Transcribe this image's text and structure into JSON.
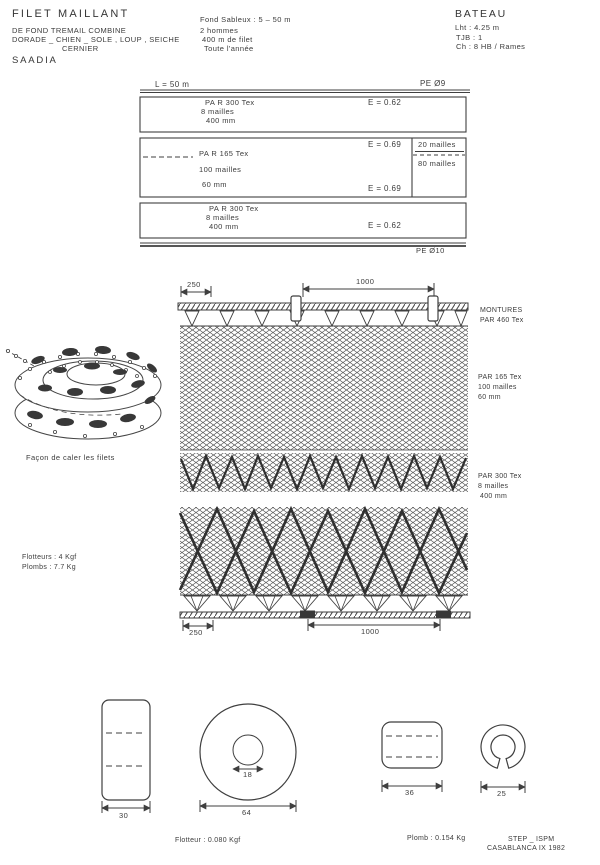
{
  "doc": {
    "title": "FILET MAILLANT",
    "type_line": "DE FOND TREMAIL COMBINE",
    "species_line": "DORADE _ CHIEN _ SOLE , LOUP , SEICHE",
    "species_line2": "CERNIER",
    "port": "SAADIA",
    "conditions": [
      "Fond Sableux : 5 – 50 m",
      "2 hommes",
      "400 m de filet",
      "Toute l'année"
    ],
    "boat_title": "BATEAU",
    "boat_specs": [
      "Lht : 4.25 m",
      "TJB : 1",
      "Ch : 8 HB / Rames"
    ]
  },
  "plan": {
    "length": "L = 50 m",
    "rope_top": "PE Ø9",
    "rope_bottom": "PE Ø10",
    "p1_material": "PA R 300 Tex",
    "p1_meshes": "8 mailles",
    "p1_size": "400 mm",
    "p1_e": "E = 0.62",
    "p2_material": "PA R 165 Tex",
    "p2_meshes": "100 mailles",
    "p2_size": "60 mm",
    "p2_e_top": "E = 0.69",
    "p2_e_bot": "E = 0.69",
    "p2_sub_top": "20 mailles",
    "p2_sub_bot": "80 mailles",
    "p3_material": "PA R 300 Tex",
    "p3_meshes": "8 mailles",
    "p3_size": "400 mm",
    "p3_e": "E = 0.62"
  },
  "detail": {
    "dim_top_left": "250",
    "dim_top_center": "1000",
    "dim_bot_left": "250",
    "dim_bot_center": "1000",
    "montures1": "MONTURES",
    "montures2": "PAR 460 Tex",
    "mid1": "PAR 165 Tex",
    "mid2": "100 mailles",
    "mid3": "60 mm",
    "low1": "PAR 300 Tex",
    "low2": "8 mailles",
    "low3": "400 mm"
  },
  "coil": {
    "caption": "Façon de caler les filets"
  },
  "totals": {
    "floats": "Flotteurs : 4 Kgf",
    "leads": "Plombs : 7.7 Kg"
  },
  "parts": {
    "float_width": "30",
    "float_hole": "18",
    "float_diameter": "64",
    "lead_length": "36",
    "lead_diameter": "25",
    "float_caption": "Flotteur : 0.080 Kgf",
    "lead_caption": "Plomb : 0.154 Kg"
  },
  "footer": {
    "org": "STEP _ ISPM",
    "place_date": "CASABLANCA IX 1982"
  }
}
